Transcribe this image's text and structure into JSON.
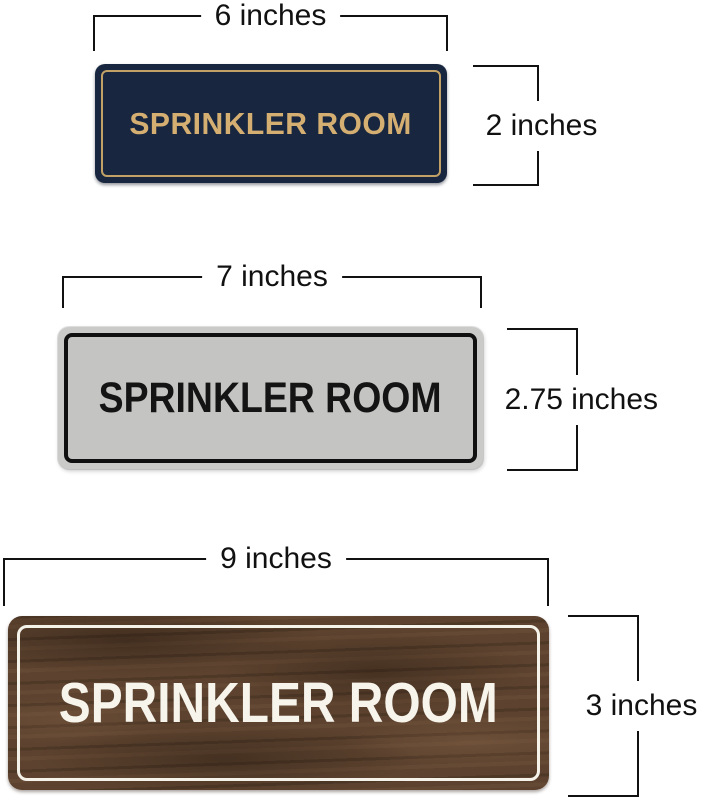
{
  "annotation_color": "#111111",
  "signs": [
    {
      "name": "navy-gold-sign",
      "text": "SPRINKLER ROOM",
      "width_label": "6 inches",
      "height_label": "2 inches",
      "colors": {
        "background": "#18273f",
        "border": "#c2a167",
        "text": "#d5ae72"
      }
    },
    {
      "name": "silver-black-sign",
      "text": "SPRINKLER ROOM",
      "width_label": "7 inches",
      "height_label": "2.75 inches",
      "colors": {
        "background": "#c4c4c2",
        "edge": "#cacac8",
        "border": "#101010",
        "text": "#141414"
      }
    },
    {
      "name": "walnut-wood-sign",
      "text": "SPRINKLER ROOM",
      "width_label": "9 inches",
      "height_label": "3 inches",
      "colors": {
        "background": "#5d432f",
        "border": "#f5f2e9",
        "text": "#f7f4ec"
      }
    }
  ]
}
